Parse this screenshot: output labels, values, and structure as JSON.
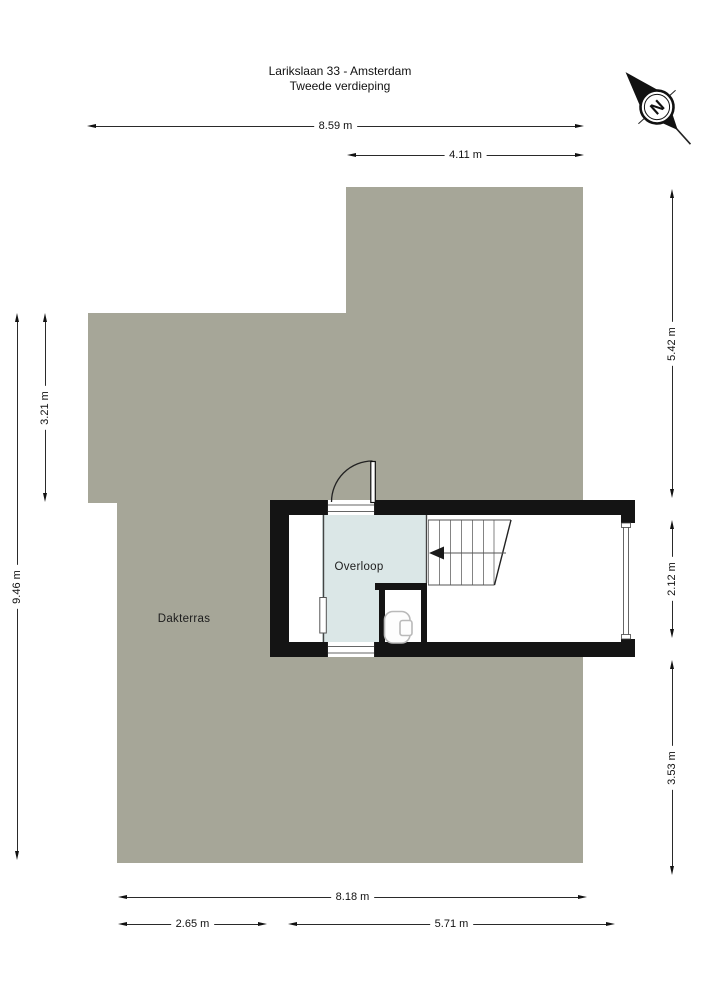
{
  "title": {
    "line1": "Larikslaan 33 - Amsterdam",
    "line2": "Tweede verdieping"
  },
  "compass": {
    "north_label": "N"
  },
  "rooms": {
    "dakterras": {
      "label": "Dakterras"
    },
    "overloop": {
      "label": "Overloop"
    }
  },
  "dimensions": {
    "top_total_width": "8.59 m",
    "top_right_wing_width": "4.11 m",
    "left_total_depth": "9.46 m",
    "left_upper_depth": "3.21 m",
    "right_upper_depth": "5.42 m",
    "right_stairwell_depth": "2.12 m",
    "right_lower_depth": "3.53 m",
    "bottom_total_width": "8.18 m",
    "bottom_left_width": "2.65 m",
    "bottom_right_width": "5.71 m"
  },
  "colors": {
    "terrace": "#a6a698",
    "hall": "#dbe7e7",
    "wall": "#141414"
  }
}
